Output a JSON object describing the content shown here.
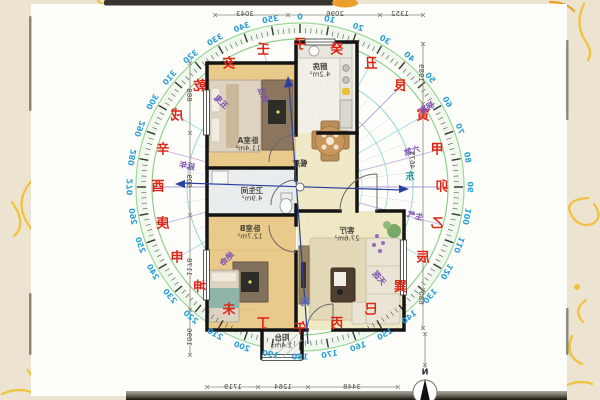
{
  "photo": {
    "background_color": "#ece4d1",
    "card_color": "#fdfdfa",
    "doodle_color": "#f0c23e",
    "orange_smudge_color": "#eca02c"
  },
  "compass": {
    "center": {
      "x": 300,
      "y": 187
    },
    "degree_color": "#2aa0d8",
    "mountain_color": "#e02515",
    "star_color": "#7b4fb0",
    "ring_color": "#9ed89a",
    "axis_color": "#2b3f9e",
    "degree_labels": [
      "0",
      "10",
      "20",
      "30",
      "40",
      "50",
      "60",
      "70",
      "80",
      "90",
      "100",
      "110",
      "120",
      "130",
      "140",
      "150",
      "160",
      "170",
      "180",
      "190",
      "200",
      "210",
      "220",
      "230",
      "240",
      "250",
      "260",
      "270",
      "280",
      "290",
      "300",
      "310",
      "320",
      "330",
      "340",
      "350"
    ],
    "mountains": [
      "子",
      "癸",
      "丑",
      "艮",
      "寅",
      "甲",
      "卯",
      "乙",
      "辰",
      "巽",
      "巳",
      "丙",
      "午",
      "丁",
      "未",
      "坤",
      "申",
      "庚",
      "酉",
      "辛",
      "戌",
      "乾",
      "亥",
      "壬"
    ],
    "stars": [
      {
        "label": "祸害",
        "x": 427,
        "y": 108,
        "rot": -32
      },
      {
        "label": "六煞",
        "x": 412,
        "y": 151,
        "rot": -18
      },
      {
        "label": "生气",
        "x": 415,
        "y": 216,
        "rot": 14
      },
      {
        "label": "天医",
        "x": 379,
        "y": 278,
        "rot": 49
      },
      {
        "label": "绝命",
        "x": 227,
        "y": 259,
        "rot": -45
      },
      {
        "label": "延年",
        "x": 187,
        "y": 166,
        "rot": 11
      },
      {
        "label": "五鬼",
        "x": 221,
        "y": 102,
        "rot": 43
      },
      {
        "label": "伏位",
        "x": 263,
        "y": 95,
        "rot": 68
      }
    ],
    "axis_labels": {
      "east": "东",
      "south": "南"
    }
  },
  "floorplan": {
    "rooms": [
      {
        "name": "卧室A",
        "area": "11.4m²",
        "x": 248,
        "y": 144
      },
      {
        "name": "厨房",
        "area": "4.2m²",
        "x": 320,
        "y": 70
      },
      {
        "name": "餐厅",
        "area": "",
        "x": 300,
        "y": 163
      },
      {
        "name": "卫生间",
        "area": "4.9m²",
        "x": 252,
        "y": 194
      },
      {
        "name": "卧室B",
        "area": "12.7m²",
        "x": 250,
        "y": 232
      },
      {
        "name": "客厅",
        "area": "27.6m²",
        "x": 347,
        "y": 234
      },
      {
        "name": "阳台",
        "area": "1.4m²",
        "x": 282,
        "y": 341
      }
    ],
    "dims": {
      "top": [
        {
          "v": "3043",
          "x": 245,
          "y": 14
        },
        {
          "v": "2096",
          "x": 335,
          "y": 14
        },
        {
          "v": "1352",
          "x": 400,
          "y": 14
        }
      ],
      "bottom": [
        {
          "v": "1719",
          "x": 233,
          "y": 387
        },
        {
          "v": "1264",
          "x": 283,
          "y": 387
        },
        {
          "v": "3448",
          "x": 352,
          "y": 387
        }
      ],
      "left": [
        {
          "v": "888",
          "x": 189,
          "y": 95
        },
        {
          "v": "609",
          "x": 189,
          "y": 181
        },
        {
          "v": "1178",
          "x": 189,
          "y": 267
        },
        {
          "v": "1096",
          "x": 189,
          "y": 337
        }
      ],
      "right": [
        {
          "v": "1989",
          "x": 421,
          "y": 73
        },
        {
          "v": "4675",
          "x": 412,
          "y": 160
        },
        {
          "v": "680",
          "x": 421,
          "y": 298
        }
      ]
    },
    "north_marker": "N"
  }
}
